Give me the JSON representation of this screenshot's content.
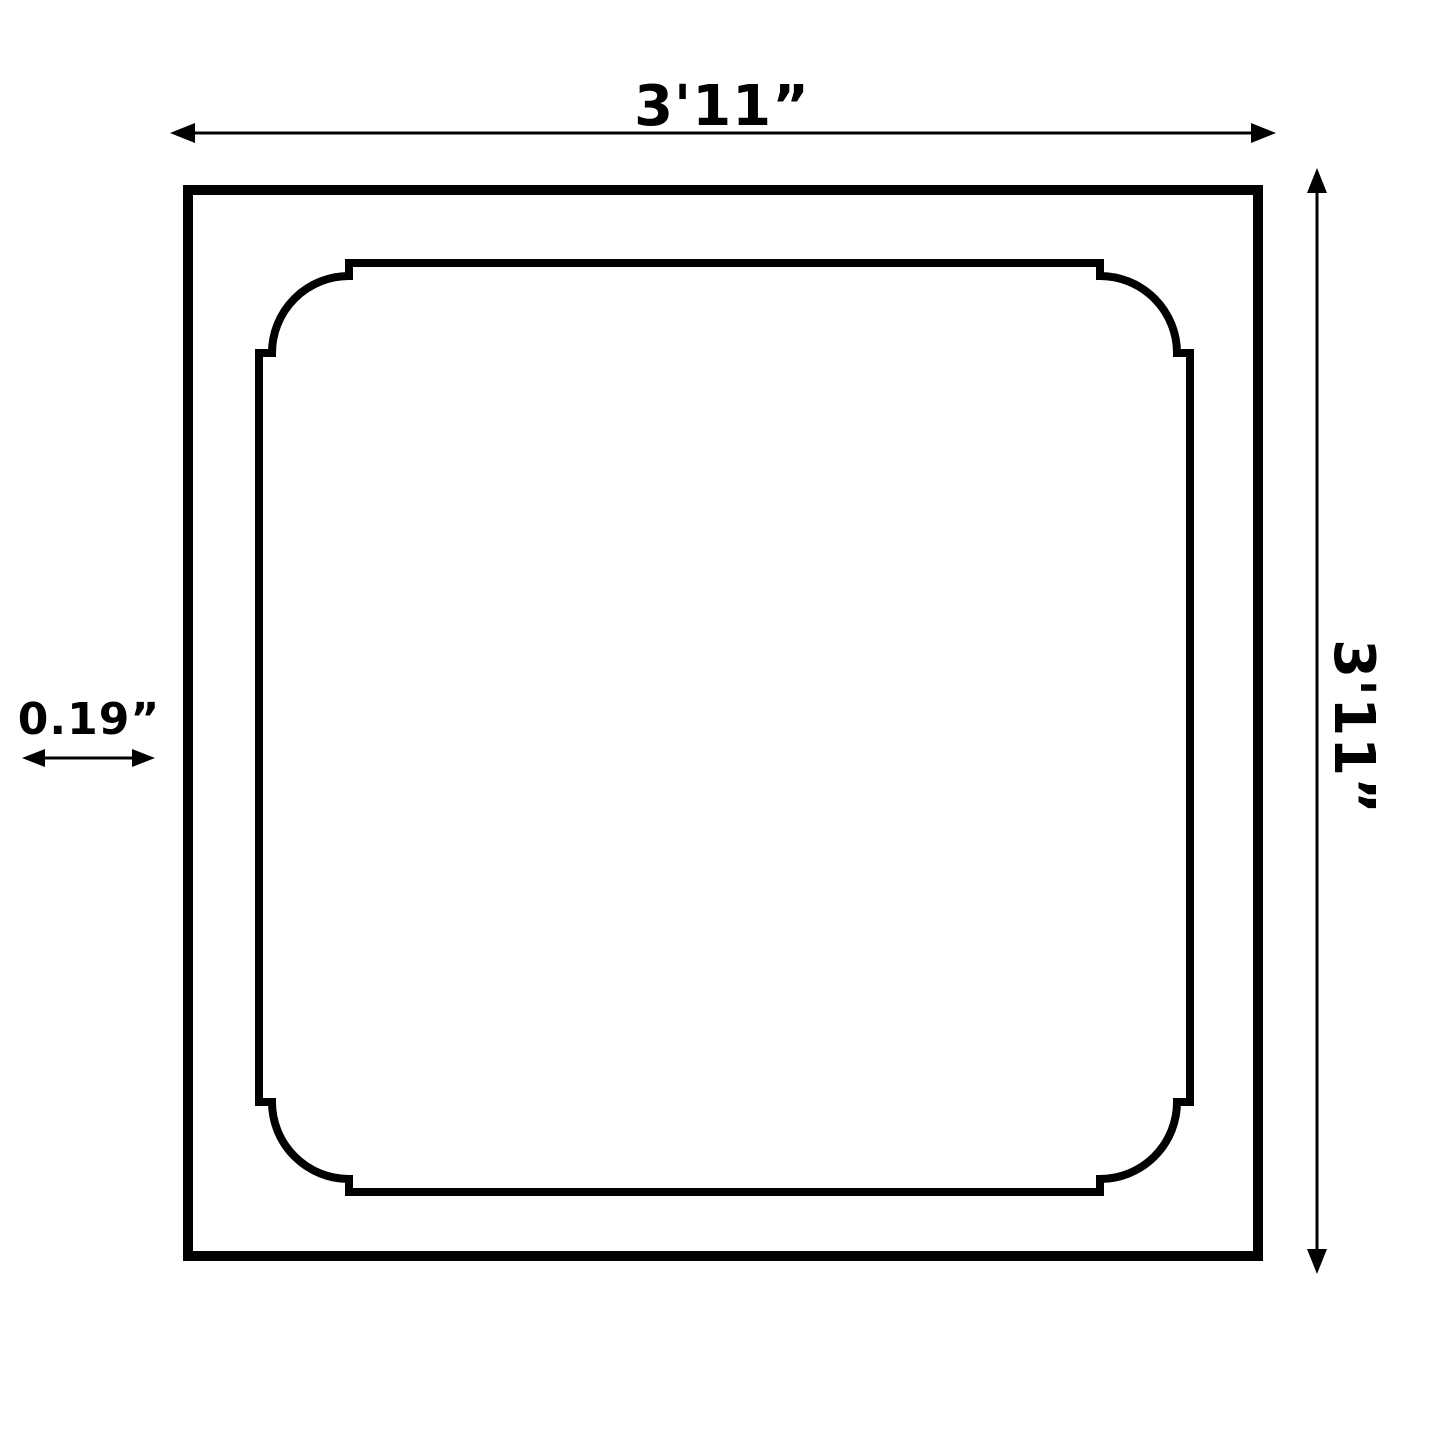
{
  "page": {
    "background_color": "#ffffff",
    "line_color": "#000000"
  },
  "diagram": {
    "type": "dimension-drawing",
    "subject": "square panel, outer frame with inner scalloped-corner moulding outline",
    "dimensions": {
      "width_label": "3'11”",
      "height_label": "3'11”",
      "thickness_label": "0.19”"
    }
  }
}
